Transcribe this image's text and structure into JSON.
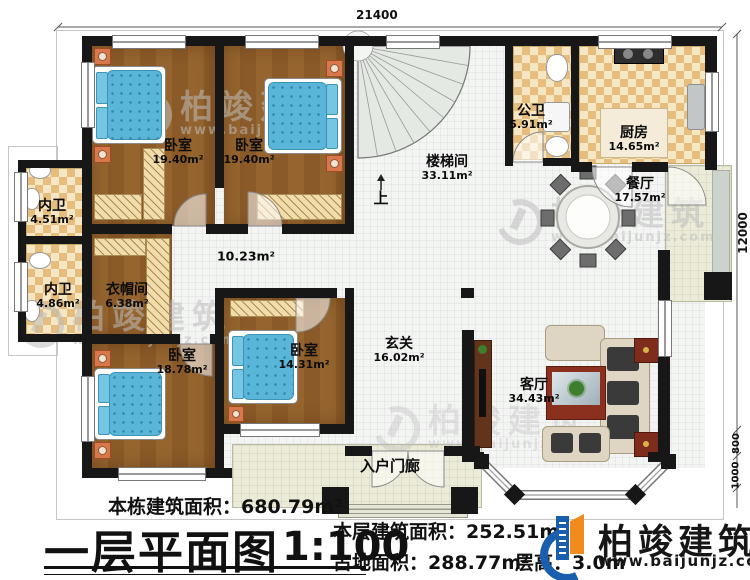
{
  "plan": {
    "dims": {
      "top": "21400",
      "right": "12000",
      "right_sub1": "800",
      "right_sub2": "1000"
    },
    "rooms": {
      "bedroom_tl": {
        "name": "卧室",
        "area": "19.40m²"
      },
      "bedroom_tr": {
        "name": "卧室",
        "area": "19.40m²"
      },
      "stair": {
        "name": "楼梯间",
        "area": "33.11m²"
      },
      "up": "上",
      "public_bath": {
        "name": "公卫",
        "area": "5.91m²"
      },
      "kitchen": {
        "name": "厨房",
        "area": "14.65m²"
      },
      "dining": {
        "name": "餐厅",
        "area": "17.57m²"
      },
      "bath_upper": {
        "name": "内卫",
        "area": "4.51m²"
      },
      "bath_lower": {
        "name": "内卫",
        "area": "4.86m²"
      },
      "cloak": {
        "name": "衣帽间",
        "area": "6.38m²"
      },
      "hall": {
        "area": "10.23m²"
      },
      "bedroom_bl": {
        "name": "卧室",
        "area": "18.78m²"
      },
      "bedroom_bm": {
        "name": "卧室",
        "area": "14.31m²"
      },
      "foyer": {
        "name": "玄关",
        "area": "16.02m²"
      },
      "living": {
        "name": "客厅",
        "area": "34.43m²"
      },
      "porch": {
        "name": "入户门廊"
      }
    }
  },
  "footer": {
    "building_total": "本栋建筑面积：680.79m²",
    "title": "一层平面图",
    "scale": "1:100",
    "floor_area": "本层建筑面积：252.51m²",
    "land_area": "占地面积：288.77m²",
    "floor_height": "层高：3.0m"
  },
  "brand": {
    "name": "柏竣建筑",
    "url": "www.baijunjz.com"
  },
  "watermark": {
    "name": "柏竣建筑",
    "url": "www.baijunjz.com"
  }
}
